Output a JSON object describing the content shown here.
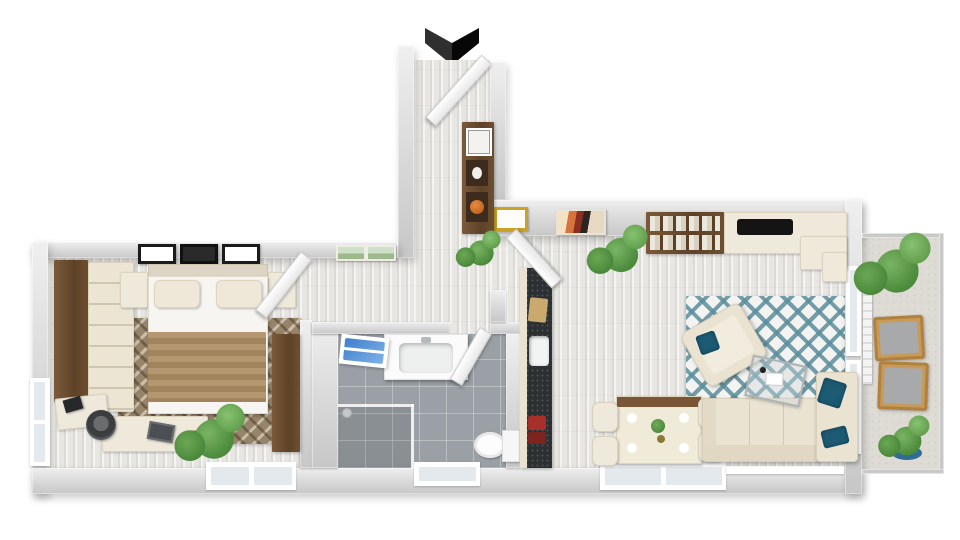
{
  "scene": {
    "title": "Apartment 3D floor plan render",
    "view": "top-down 3D dollhouse view",
    "background": "#ffffff",
    "entrance_marker": "chevron-down-arrow"
  },
  "palette": {
    "wall": "#d6d6d6",
    "wood_floor": "#e8e6e2",
    "tile_floor": "#9aa0a5",
    "balcony_floor": "#dedbd5",
    "furniture_cream": "#efe9dc",
    "wood_brown": "#6b4c30",
    "blanket_tan": "#ab8b61",
    "rug_brown": "#97856b",
    "rug_teal": "#5c8e9c",
    "pillow_teal": "#1d5a74",
    "towel_blue": "#4a86d8",
    "plant_green": "#5e9c4e",
    "balcony_chair_wood": "#c89a55",
    "cooktop_black": "#141414",
    "kitchen_counter_dark": "#2c3033",
    "entrance_arrow": "#0a0a0a"
  },
  "rooms": [
    {
      "id": "bedroom",
      "name": "Bedroom",
      "furniture": [
        "wardrobe with drawers",
        "double bed with tan blanket",
        "nightstand left",
        "nightstand right",
        "patterned brown rug",
        "tall wood cabinet",
        "corner desk",
        "office chair",
        "laptop",
        "potted plant",
        "three framed pictures",
        "side window",
        "bottom window"
      ]
    },
    {
      "id": "hallway",
      "name": "Hallway / Entrance",
      "furniture": [
        "entrance door",
        "wall shelf unit with vase and orange pot",
        "potted plant",
        "two landscape pictures",
        "bedroom door"
      ]
    },
    {
      "id": "bathroom",
      "name": "Bathroom",
      "furniture": [
        "vanity with basin",
        "blue towel radiator",
        "walk-in shower with glass",
        "toilet",
        "frosted window",
        "bathroom door"
      ]
    },
    {
      "id": "kitchen",
      "name": "Kitchenette",
      "furniture": [
        "dark counter with sink",
        "cutting board",
        "red utensils",
        "upper counter with black cooktop",
        "corner counter",
        "open shelving with dishes"
      ]
    },
    {
      "id": "living_room",
      "name": "Living / Dining Room",
      "furniture": [
        "dining table with wood trim",
        "four dining chairs",
        "sofa with chaise",
        "teal cushions",
        "armchair",
        "glass coffee table",
        "teal geometric rug",
        "gold framed picture",
        "colorful wall art",
        "potted plant",
        "bottom windows"
      ]
    },
    {
      "id": "balcony",
      "name": "Balcony",
      "furniture": [
        "glass railing",
        "two wooden chairs with grey cushions",
        "large plant",
        "potted plant in blue pot",
        "radiator"
      ]
    }
  ]
}
